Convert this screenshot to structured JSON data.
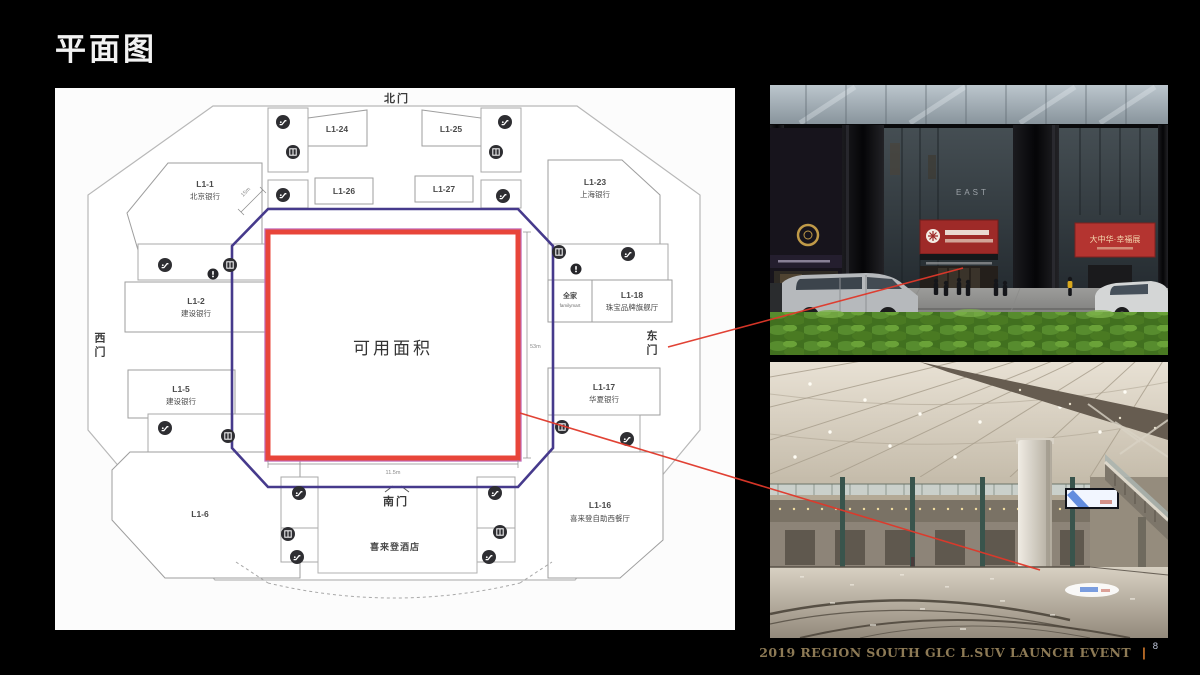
{
  "slide": {
    "title": "平面图",
    "footer": {
      "event": "2019 REGION SOUTH GLC L.SUV LAUNCH EVENT",
      "divider": "|",
      "page": "8"
    }
  },
  "plan": {
    "gates": {
      "north": "北门",
      "south": "南门",
      "west": "西门",
      "east": "东门"
    },
    "available_area_label": "可用面积",
    "hotel_label": "喜来登酒店",
    "dimensions": {
      "right": "53m",
      "bottom": "11.5m",
      "corner": "15m"
    },
    "units": {
      "l1_1": {
        "id": "L1-1",
        "name": "北京银行"
      },
      "l1_2": {
        "id": "L1-2",
        "name": "建设银行"
      },
      "l1_5": {
        "id": "L1-5",
        "name": "建设银行"
      },
      "l1_6": {
        "id": "L1-6"
      },
      "l1_16": {
        "id": "L1-16",
        "name": "喜来登自助西餐厅"
      },
      "l1_17": {
        "id": "L1-17",
        "name": "华夏银行"
      },
      "l1_18": {
        "id": "L1-18",
        "name": "珠宝品牌旗舰厅"
      },
      "l1_23": {
        "id": "L1-23",
        "name": "上海银行"
      },
      "l1_24": {
        "id": "L1-24"
      },
      "l1_25": {
        "id": "L1-25"
      },
      "l1_26": {
        "id": "L1-26"
      },
      "l1_27": {
        "id": "L1-27"
      },
      "familymart": {
        "id": "全家",
        "name": "familymart"
      }
    },
    "icon_types": [
      "escalator-icon",
      "elevator-icon",
      "accessible-info-icon"
    ]
  },
  "photos": {
    "top": {
      "building_sign": "EAST",
      "right_banner": "大中华·幸福展"
    },
    "bottom": {}
  },
  "colors": {
    "available_area_border": "#e8453a",
    "plan_boundary": "#463a8c",
    "inner_outline": "#c06bb8",
    "annotation_line": "#e0382a",
    "footer_text": "#8d7a55",
    "footer_divider": "#c8742a"
  }
}
